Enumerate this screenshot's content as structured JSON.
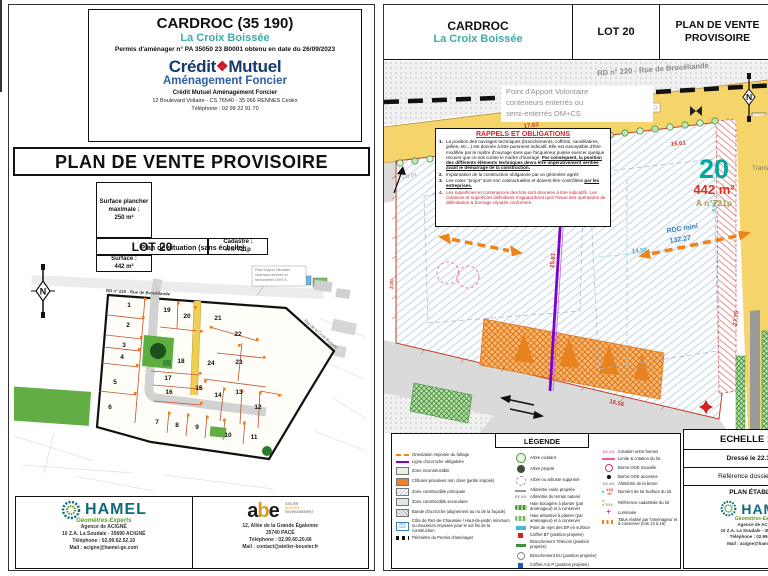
{
  "colors": {
    "accent_teal": "#3dada5",
    "cm_navy": "#16396e",
    "cm_red": "#cf1928",
    "hamel_teal": "#0f6b7c",
    "road_yellow": "#f5d569",
    "lot_teal": "#00a79b",
    "surface_red": "#e0301e",
    "purple": "#7d00cc",
    "arrow_orange": "#ef8318"
  },
  "page_left": {
    "header": {
      "title": "CARDROC (35 190)",
      "subtitle": "La Croix Boissée",
      "permit": "Permis d'aménager n° PA 35050 23 B0001 obtenu en date du 26/09/2023",
      "brand_left": "Crédit",
      "brand_glyph": "❖",
      "brand_right": "Mutuel",
      "brand_sub": "Aménagement Foncier",
      "company": "Crédit Mutuel Aménagement Foncier",
      "address": "12 Boulevard Voltaire - CS 76540 - 35 066 RENNES Cedex",
      "phone": "Téléphone : 02 99 22 91 70"
    },
    "doc_title": "PLAN DE VENTE PROVISOIRE",
    "lot_table": {
      "lot": "LOT 20",
      "cadastre_label": "Cadastre :",
      "cadastre_value": "A n°721p",
      "surface_label": "Surface :",
      "surface_value": "442 m²",
      "floor_label": "Surface plancher maximale :",
      "floor_value": "250 m²"
    },
    "situation": {
      "caption": "Plan de situation (sans échelle)",
      "north": "N",
      "road_top": "RD  n° 220 - Rue de Brocéliande",
      "road_right": "Rue de la Croix Boissée",
      "callout1": "Point d'Apport Volontaire",
      "callout2": "conteneurs enterrés ou",
      "callout3": "semi-enterrés OM+CS",
      "lots": [
        "1",
        "2",
        "3",
        "4",
        "5",
        "6",
        "7",
        "8",
        "9",
        "10",
        "11",
        "12",
        "13",
        "14",
        "15",
        "16",
        "17",
        "18",
        "19",
        "20",
        "21",
        "22",
        "23",
        "24"
      ]
    },
    "footer": {
      "hamel": {
        "name": "HAMEL",
        "tagline": "Géomètres-Experts",
        "line1": "Agence de ACIGNÉ",
        "line2": "10 Z.A. La Soudale - 35690 ACIGNÉ",
        "line3": "Téléphone : 02.99.62.52.10",
        "line4": "Mail : acigne@hamel-ge.com"
      },
      "abe": {
        "a": "a",
        "b": "b",
        "e": "e",
        "tag1": "ATELIER",
        "tag2": "BOUVIER",
        "tag3": "ENVIRONNEMENT",
        "line1": "12, Allée de la Grande Égalonne",
        "line2": "35740 PACÉ",
        "line3": "Téléphone : 02.99.60.20.66",
        "line4": "Mail : contact@atelier-bouvier.fr"
      }
    }
  },
  "page_right": {
    "header": {
      "title": "CARDROC",
      "subtitle": "La Croix Boissée",
      "lot": "LOT 20",
      "doc_title": "PLAN DE VENTE PROVISOIRE"
    },
    "plan": {
      "road_label": "RD  n° 220 - Rue de Brocéliande",
      "pav1": "Point d'Apport Volontaire",
      "pav2": "conteneurs enterrés ou",
      "pav3": "semi-enterrés OM+CS",
      "transformer": "Transformateur",
      "north": "N",
      "lot_number": "20",
      "surface": "442 m²",
      "cadastre": "A n°721p",
      "rdc1": "RDC mini",
      "rdc2": "132.27",
      "m1": "17.63",
      "m2": "16.61",
      "m3": "25.81",
      "m4": "27.75",
      "m5": "16.56",
      "m6": "14.50",
      "m7": "132.64",
      "m8": "2.00",
      "m9": "4.96"
    },
    "rappels": {
      "title": "RAPPELS ET OBLIGATIONS",
      "items": [
        {
          "n": "1.",
          "t1": "La position des ouvrages techniques (branchements, coffrets, candélabres, grilles, etc...) est donnée à titre purement indicatif. Elle est susceptible d'être modifiée par le maître d'ouvrage sans que l'acquéreur puisse exercer quelque recours que ce soit contre le maître d'ouvrage. ",
          "t2": "Par conséquent, la position des différents éléments techniques devra être impérativement vérifiée avant le démarrage de la construction."
        },
        {
          "n": "2.",
          "t1": "Implantation de la construction obligatoire par un géomètre agréé",
          "t2": ""
        },
        {
          "n": "3.",
          "t1": "Les cotes \"projet\" sont non contractuelles et doivent être contrôlées ",
          "t2": "par les entreprises."
        },
        {
          "n": "4.",
          "t1": "Les superficies et contenances des lots sont données à titre indicatifs. Les cotations et superficies définitives n'apparaîtront qu'à l'issue des opérations de délimitation & bornage réputés conformes.",
          "t2": ""
        }
      ]
    },
    "legend": {
      "title": "LÉGENDE",
      "col1": [
        "Orientation imposée du faîtage",
        "Ligne d'accroche obligatoire",
        "Zone inconstructible",
        "Clôtures privatives non close (jardin imposé)",
        "Zone constructible principale",
        "Zone constructible secondaire",
        "Bande d'accroche (alignement au nu de la façade)",
        "Côte de Rez-de-Chaussée / Haut-de-jardin minimum ou maximum imposée pour le sol fini de la construction",
        "Périmètre du Permis d'aménager"
      ],
      "col2": [
        "Arbre existant",
        "Arbre projeté",
        "Arbre ou arbuste supprimé",
        "Altimétrie voirie projetée",
        "Altimétrie du terrain naturel",
        "Haie bocagère à planter (par aménageur) et à conserver",
        "Haie arbustive à planter (par aménageur) et à conserver",
        "Point de rejet des EP en surface",
        "Coffret BT (position projetée)",
        "Branchement Télécom (position projetée)",
        "Branchement EU (position projetée)",
        "Coffret A.E.P (position projetée)"
      ],
      "col3": [
        "Cotation entre bornes",
        "Limite & cotation du lot",
        "Borne OGE nouvelle",
        "Borne OGE ancienne",
        "Altimétrie de la borne",
        "Numéro de lot Surface du lot",
        "Référence cadastrale du lot",
        "Luminaire",
        "Talus réalisé par l'aménageur et à conserver (lots 13 à 16)"
      ],
      "sym_xx": "XX.XX",
      "sym_x": "X",
      "sym_xm": "XXX m²",
      "sym_an": "A n°XXX",
      "sym_plus": "+"
    },
    "titleblock": {
      "scale": "ECHELLE 1 / 200",
      "date": "Dressé le 22.11.2023",
      "ref": "Référence dossier : 220622",
      "established": "PLAN ÉTABLI PAR",
      "hamel_name": "HAMEL",
      "hamel_tag": "Géomètres-Experts",
      "line1": "Agence de ACIGNÉ",
      "line2": "10 Z.A. La Soudale - 35690 ACIGNÉ",
      "line3": "Téléphone : 02.99.62.52.10",
      "line4": "Mail : acigne@hamel-ge.com"
    }
  }
}
